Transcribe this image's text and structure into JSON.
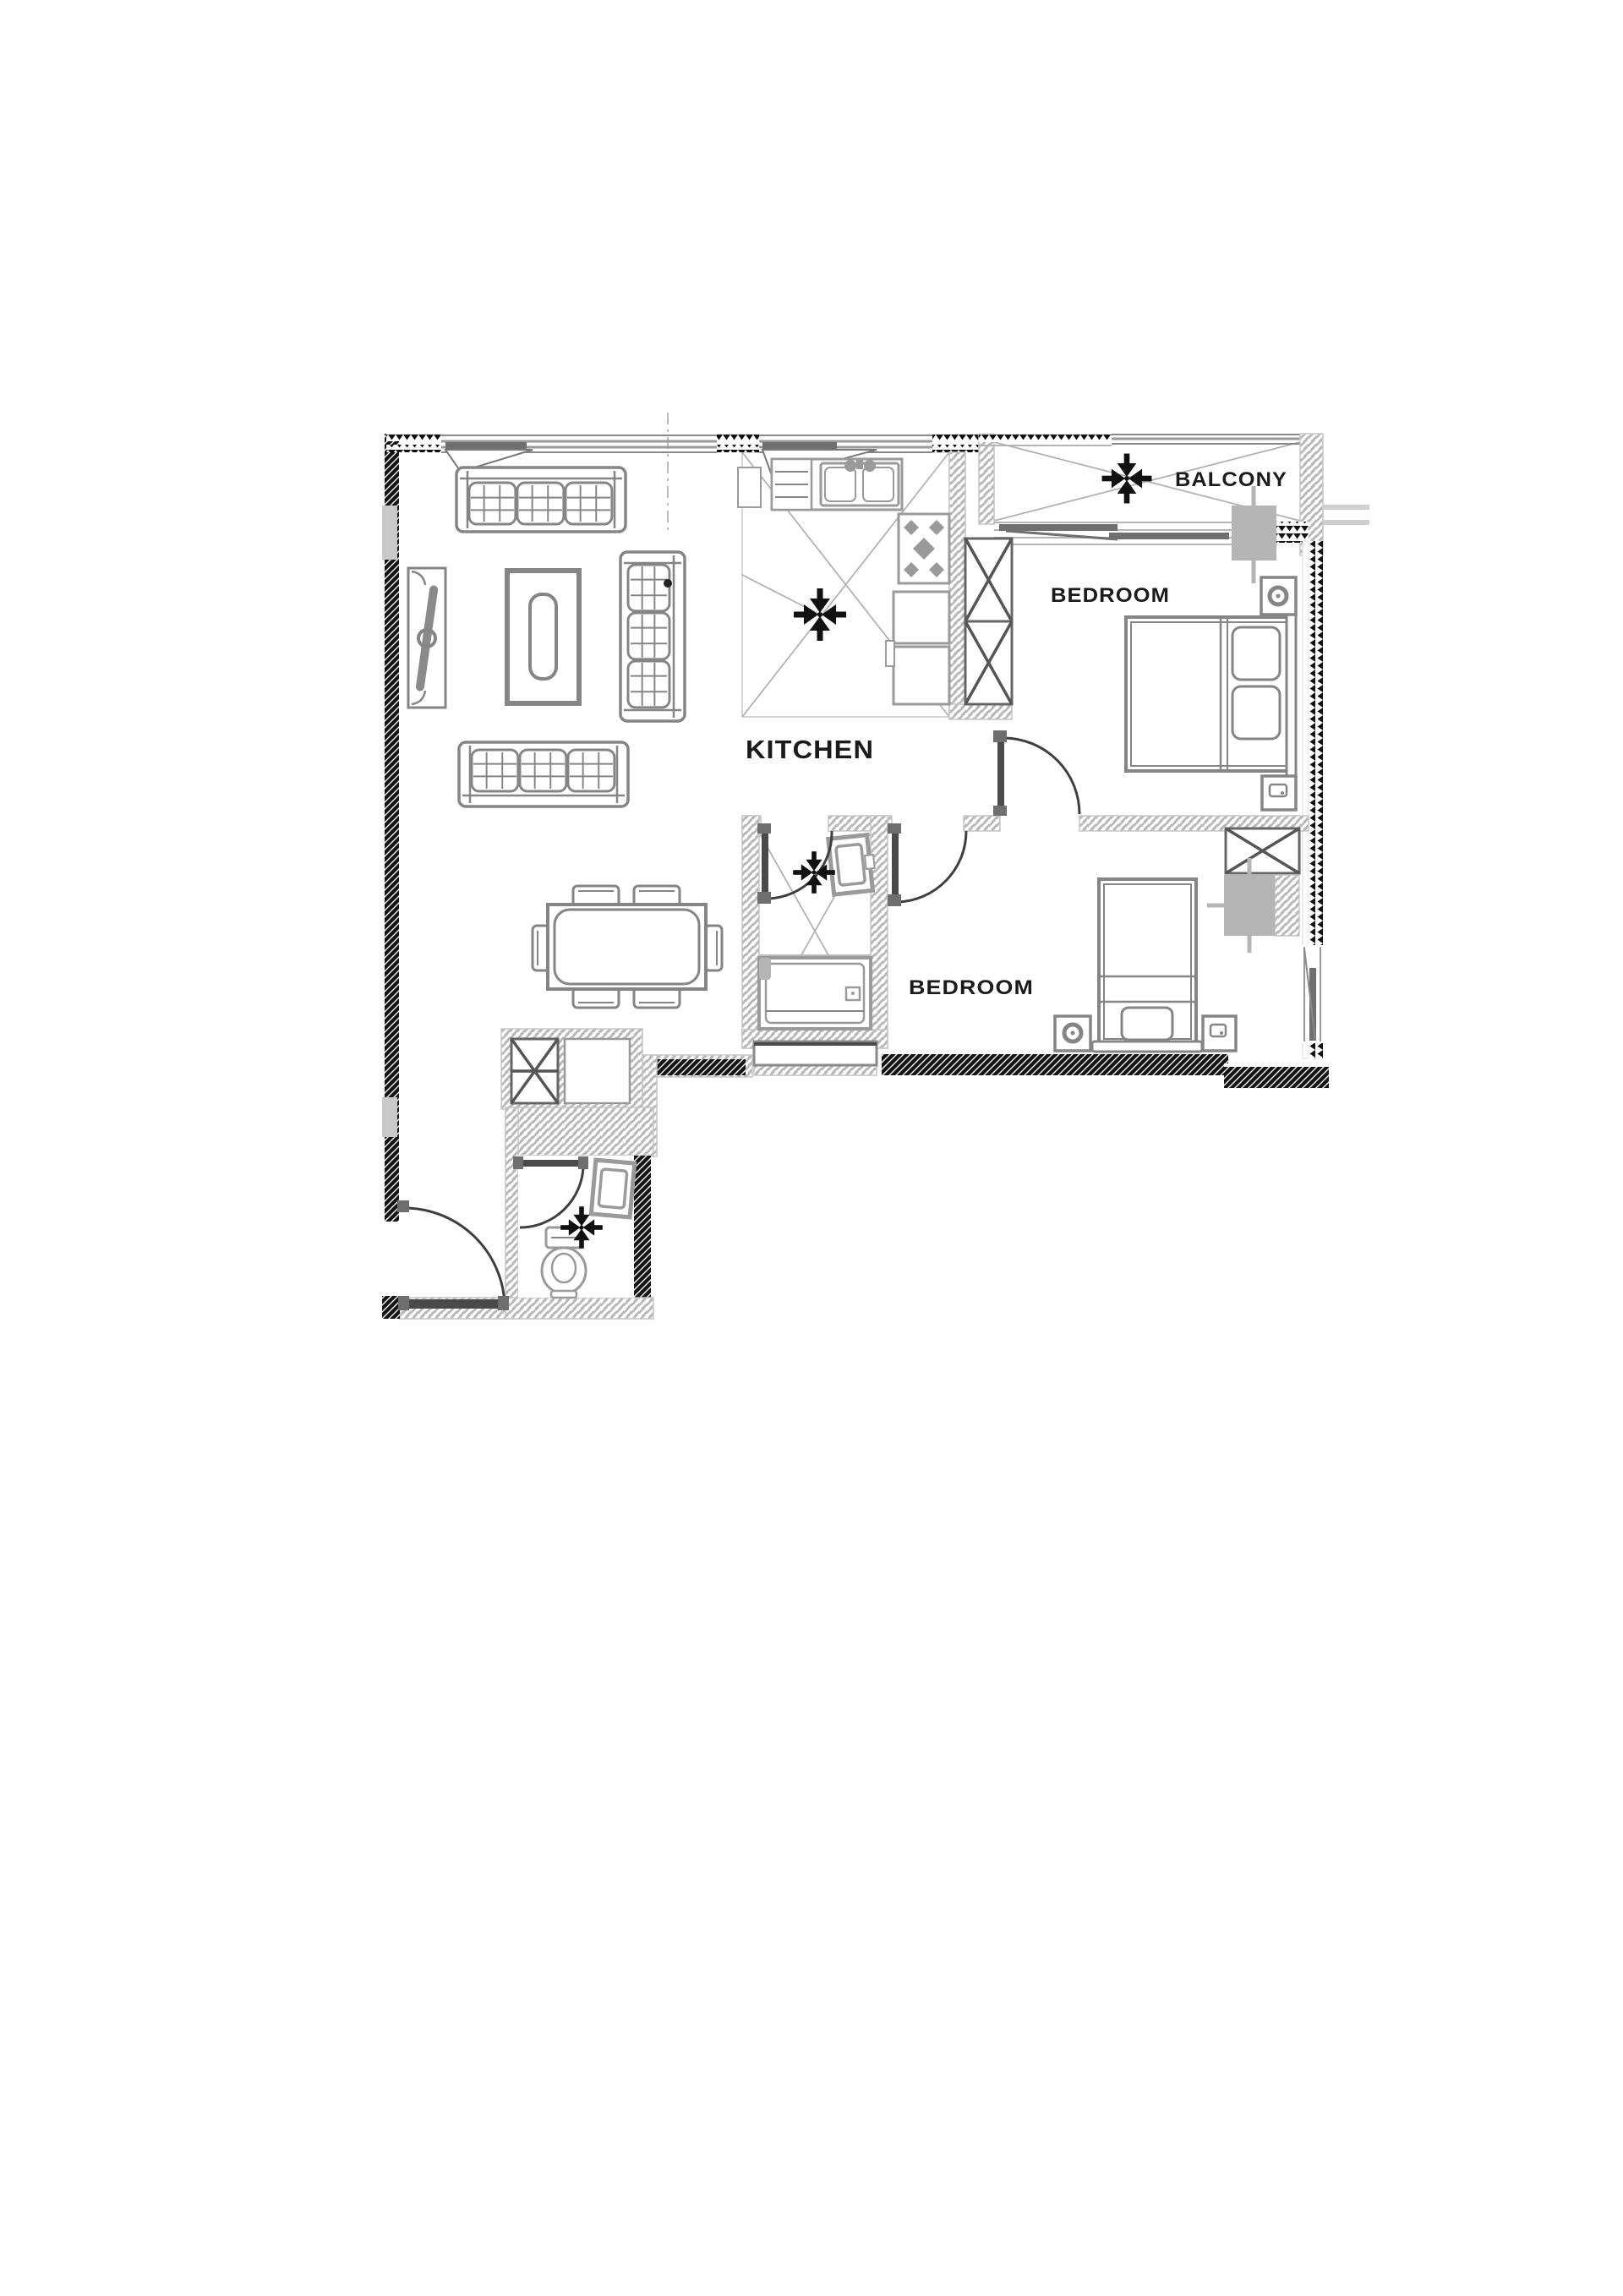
{
  "floor_plan": {
    "labels": {
      "kitchen": "KITCHEN",
      "bedroom_top": "BEDROOM",
      "bedroom_bottom": "BEDROOM",
      "balcony": "BALCONY"
    },
    "colors": {
      "background": "#ffffff",
      "wall_dark": "#141414",
      "wall_hatch_light": "#b8b8b8",
      "furniture_stroke": "#858585",
      "fixture_stroke": "#9a9a9a",
      "door_leaf": "#4a4a4a",
      "ac_unit_fill": "#b5b5b5",
      "floor_mark": "#b2b2b2",
      "label_text": "#1b1b1b"
    },
    "icons": [
      "exhaust-fan-icon",
      "double-bed-icon",
      "single-bed-icon",
      "sofa-icon",
      "coffee-table-icon",
      "tv-console-icon",
      "dining-table-icon",
      "wardrobe-x-icon",
      "stove-icon",
      "kitchen-sink-icon",
      "bathtub-icon",
      "shower-icon",
      "toilet-icon",
      "wash-basin-icon",
      "washing-machine-icon",
      "ac-unit-icon",
      "door-swing-icon",
      "window-icon",
      "entrance-door-icon"
    ]
  }
}
